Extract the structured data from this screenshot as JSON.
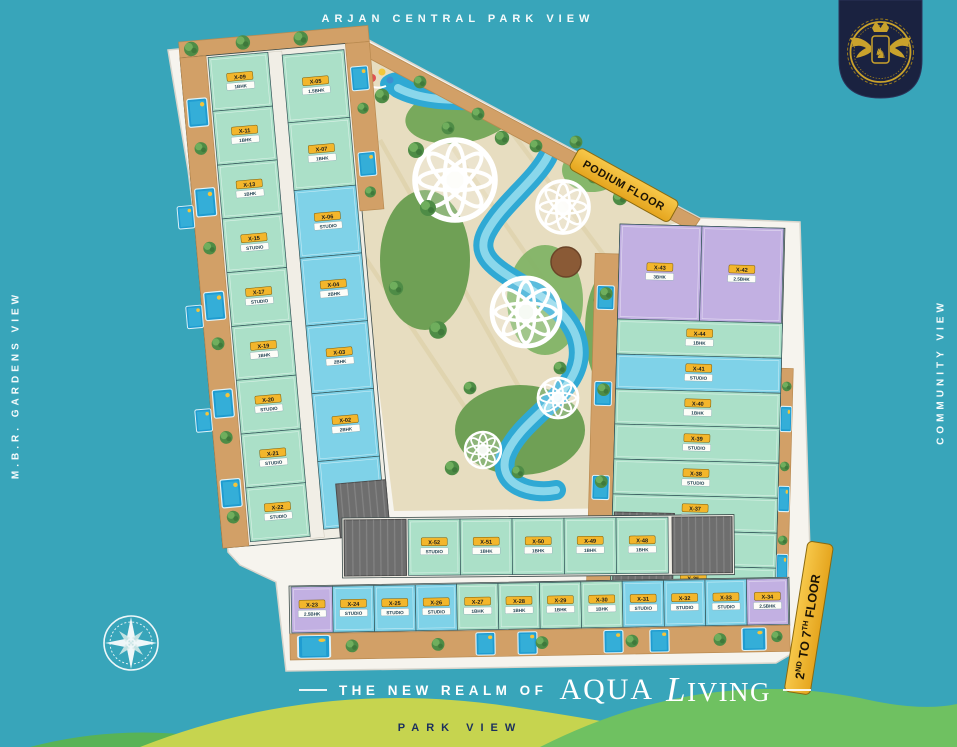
{
  "labels": {
    "top": "ARJAN CENTRAL PARK VIEW",
    "left": "M.B.R. GARDENS VIEW",
    "right": "COMMUNITY VIEW",
    "bottom": "PARK VIEW"
  },
  "tagline": {
    "prefix": "THE NEW REALM OF",
    "brand_word_1": "AQUA",
    "brand_word_2": "LIVING"
  },
  "banners": {
    "podium": "PODIUM FLOOR",
    "floors": {
      "p1": "2",
      "s1": "ND",
      "p2": "TO 7",
      "s2": "TH",
      "p3": "FLOOR"
    }
  },
  "icons": {
    "crest": "winged-horse-crest",
    "compass": "compass-rose"
  },
  "colors": {
    "background": "#38a5ba",
    "banner_yellow": "#f2b62d",
    "navy": "#1a2240",
    "gold": "#c9a22c",
    "wood": "#d2a067",
    "mint": "#abe0c8",
    "blue": "#7fd2e8",
    "purple": "#c2b0e2",
    "pool": "#1f9cd1",
    "garden_green": "#76a75a",
    "hill_yellow_green": "#c6d44f",
    "hill_green": "#6fc161"
  },
  "units": {
    "left_outer": [
      {
        "id": "X-09",
        "type": "1BHK",
        "c": "mint"
      },
      {
        "id": "X-11",
        "type": "1BHK",
        "c": "mint"
      },
      {
        "id": "X-13",
        "type": "1BHK",
        "c": "mint"
      },
      {
        "id": "X-15",
        "type": "STUDIO",
        "c": "mint"
      },
      {
        "id": "X-17",
        "type": "STUDIO",
        "c": "mint"
      },
      {
        "id": "X-19",
        "type": "1BHK",
        "c": "mint"
      },
      {
        "id": "X-20",
        "type": "STUDIO",
        "c": "mint"
      },
      {
        "id": "X-21",
        "type": "STUDIO",
        "c": "mint"
      },
      {
        "id": "X-22",
        "type": "STUDIO",
        "c": "mint"
      }
    ],
    "left_inner": [
      {
        "id": "X-05",
        "type": "1.5BHK",
        "c": "mint"
      },
      {
        "id": "X-07",
        "type": "1BHK",
        "c": "mint"
      },
      {
        "id": "X-06",
        "type": "STUDIO",
        "c": "blue"
      },
      {
        "id": "X-04",
        "type": "2BHK",
        "c": "blue"
      },
      {
        "id": "X-03",
        "type": "2BHK",
        "c": "blue"
      },
      {
        "id": "X-02",
        "type": "2BHK",
        "c": "blue"
      },
      {
        "id": "X-01",
        "type": "1BHK",
        "c": "blue"
      }
    ],
    "mid_strip": [
      {
        "id": "X-52",
        "type": "STUDIO",
        "c": "mint"
      },
      {
        "id": "X-51",
        "type": "1BHK",
        "c": "mint"
      },
      {
        "id": "X-50",
        "type": "1BHK",
        "c": "mint"
      },
      {
        "id": "X-49",
        "type": "1BHK",
        "c": "mint"
      },
      {
        "id": "X-48",
        "type": "1BHK",
        "c": "mint"
      }
    ],
    "bottom_row": [
      {
        "id": "X-23",
        "type": "2.5BHK",
        "c": "purple"
      },
      {
        "id": "X-24",
        "type": "STUDIO",
        "c": "blue"
      },
      {
        "id": "X-25",
        "type": "STUDIO",
        "c": "blue"
      },
      {
        "id": "X-26",
        "type": "STUDIO",
        "c": "blue"
      },
      {
        "id": "X-27",
        "type": "1BHK",
        "c": "mint"
      },
      {
        "id": "X-28",
        "type": "1BHK",
        "c": "mint"
      },
      {
        "id": "X-29",
        "type": "1BHK",
        "c": "mint"
      },
      {
        "id": "X-30",
        "type": "1BHK",
        "c": "mint"
      },
      {
        "id": "X-31",
        "type": "STUDIO",
        "c": "blue"
      },
      {
        "id": "X-32",
        "type": "STUDIO",
        "c": "blue"
      },
      {
        "id": "X-33",
        "type": "STUDIO",
        "c": "blue"
      },
      {
        "id": "X-34",
        "type": "2.5BHK",
        "c": "purple"
      }
    ],
    "right_head": [
      {
        "id": "X-43",
        "type": "3BHK",
        "c": "purple"
      },
      {
        "id": "X-42",
        "type": "2.5BHK",
        "c": "purple"
      }
    ],
    "right_col": [
      {
        "id": "X-44",
        "type": "1BHK",
        "c": "mint"
      },
      {
        "id": "X-41",
        "type": "STUDIO",
        "c": "blue"
      },
      {
        "id": "X-40",
        "type": "1BHK",
        "c": "mint"
      },
      {
        "id": "X-39",
        "type": "STUDIO",
        "c": "mint"
      },
      {
        "id": "X-38",
        "type": "STUDIO",
        "c": "mint"
      },
      {
        "id": "X-37",
        "type": "1BHK",
        "c": "mint"
      },
      {
        "id": "X-36",
        "type": "STUDIO",
        "c": "mint"
      },
      {
        "id": "X-35",
        "type": "STUDIO",
        "c": "mint"
      }
    ]
  }
}
